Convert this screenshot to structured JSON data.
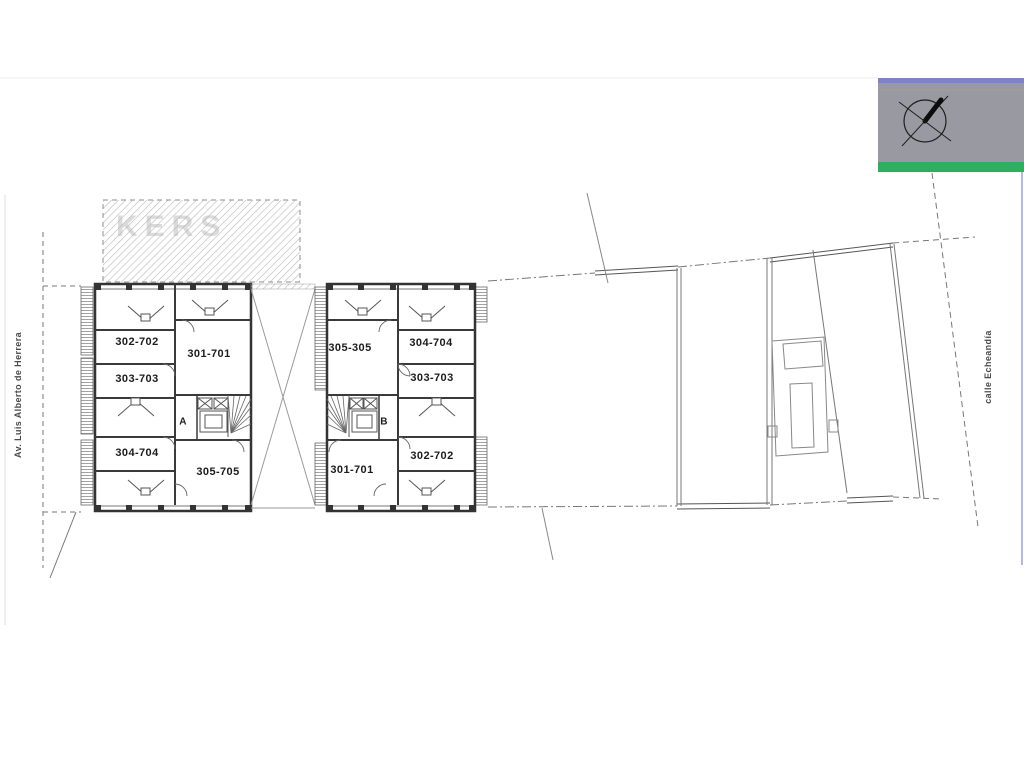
{
  "drawing": {
    "type": "architectural floor plan",
    "watermark": "KERS",
    "streets": {
      "left": "Av. Luis Alberto de Herrera",
      "right": "calle Echeandía"
    },
    "buildings": {
      "a": {
        "core_label": "A",
        "units": [
          {
            "label": "302-702"
          },
          {
            "label": "301-701"
          },
          {
            "label": "303-703"
          },
          {
            "label": "304-704"
          },
          {
            "label": "305-705"
          }
        ]
      },
      "b": {
        "core_label": "B",
        "units": [
          {
            "label": "305-305"
          },
          {
            "label": "304-704"
          },
          {
            "label": "303-703"
          },
          {
            "label": "301-701"
          },
          {
            "label": "302-702"
          }
        ]
      }
    },
    "legend_badge": {
      "box_color": "#999aa1",
      "top_strip_color": "#7e82c6",
      "bar_color": "#2fae60",
      "icon": "north-arrow-compass"
    },
    "line_colors": {
      "wall": "#333333",
      "interior": "#555555",
      "boundary": "#777777",
      "hatch": "#b9b9b9"
    }
  }
}
